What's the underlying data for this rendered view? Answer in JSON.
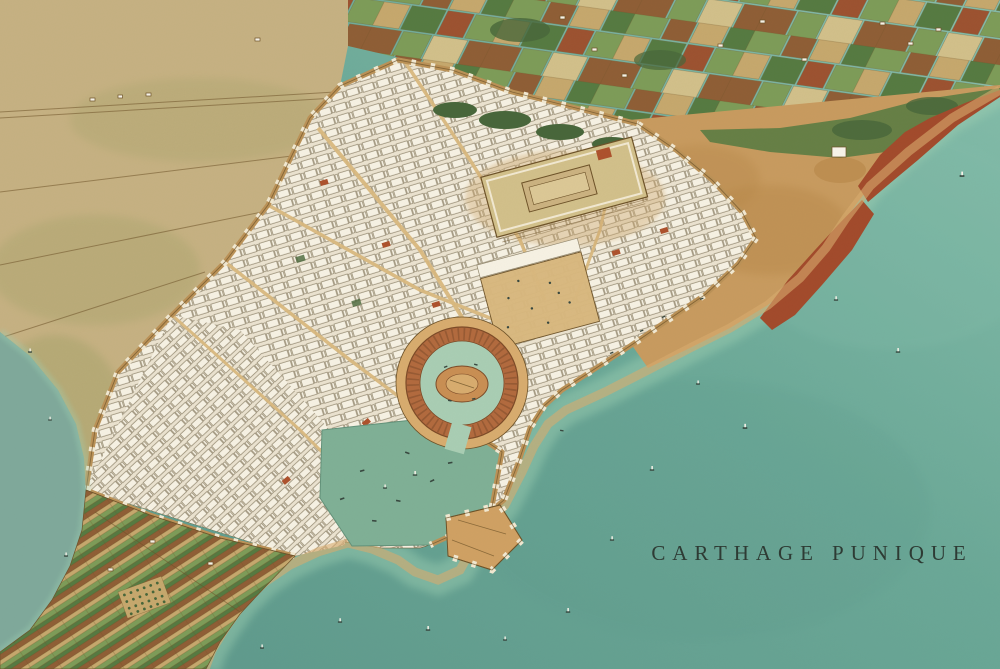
{
  "artwork": {
    "title": "CARTHAGE PUNIQUE"
  },
  "palette": {
    "sea_light": "#86bfac",
    "sea_mid": "#6aa897",
    "sea_deep": "#5c978a",
    "shallow": "#9ed0b3",
    "lagoon": "#7fa99b",
    "plain": "#c6b182",
    "olive": "#9fa066",
    "hills": "#c89b5f",
    "hill_shade": "#b38444",
    "cliff": "#a24a2b",
    "field_green": "#7d9c58",
    "field_green_dark": "#557a41",
    "field_brown": "#8f5e35",
    "field_tan": "#c6a86d",
    "field_rust": "#9c5230",
    "field_pale": "#d2c08a",
    "grove": "#47663a",
    "city": "#ebe3d0",
    "block": "#f7f2e4",
    "block_line": "#92876e",
    "street": "#d9b87e",
    "wall": "#bb9257",
    "wall_light": "#f2e9d2",
    "wall_dark": "#6d5228",
    "sand": "#d8ac6e",
    "ring": "#b26a3e",
    "ring_dark": "#7c4a27",
    "harbour_water": "#a9ceb4",
    "island": "#c98f53",
    "basin": "#7fb096",
    "basin_dark": "#62927a",
    "pier": "#d0a163",
    "roof": "#ad512c",
    "white": "#f8f4ea",
    "dark": "#37473f",
    "ink": "#2e3b34"
  },
  "features": [
    "mediterranean-sea",
    "coastal-shallows",
    "lagoon",
    "countryside-plain",
    "farmland-patchwork",
    "northeast-hills",
    "sea-cliffs",
    "hilltop-fort",
    "walled-city",
    "city-walls",
    "byrsa-acropolis",
    "acropolis-temple",
    "agora-square",
    "circular-military-harbour",
    "admiral-island",
    "rectangular-merchant-harbour",
    "harbour-pier",
    "peninsula-fields",
    "orchard",
    "sailing-boats",
    "title-caption"
  ]
}
